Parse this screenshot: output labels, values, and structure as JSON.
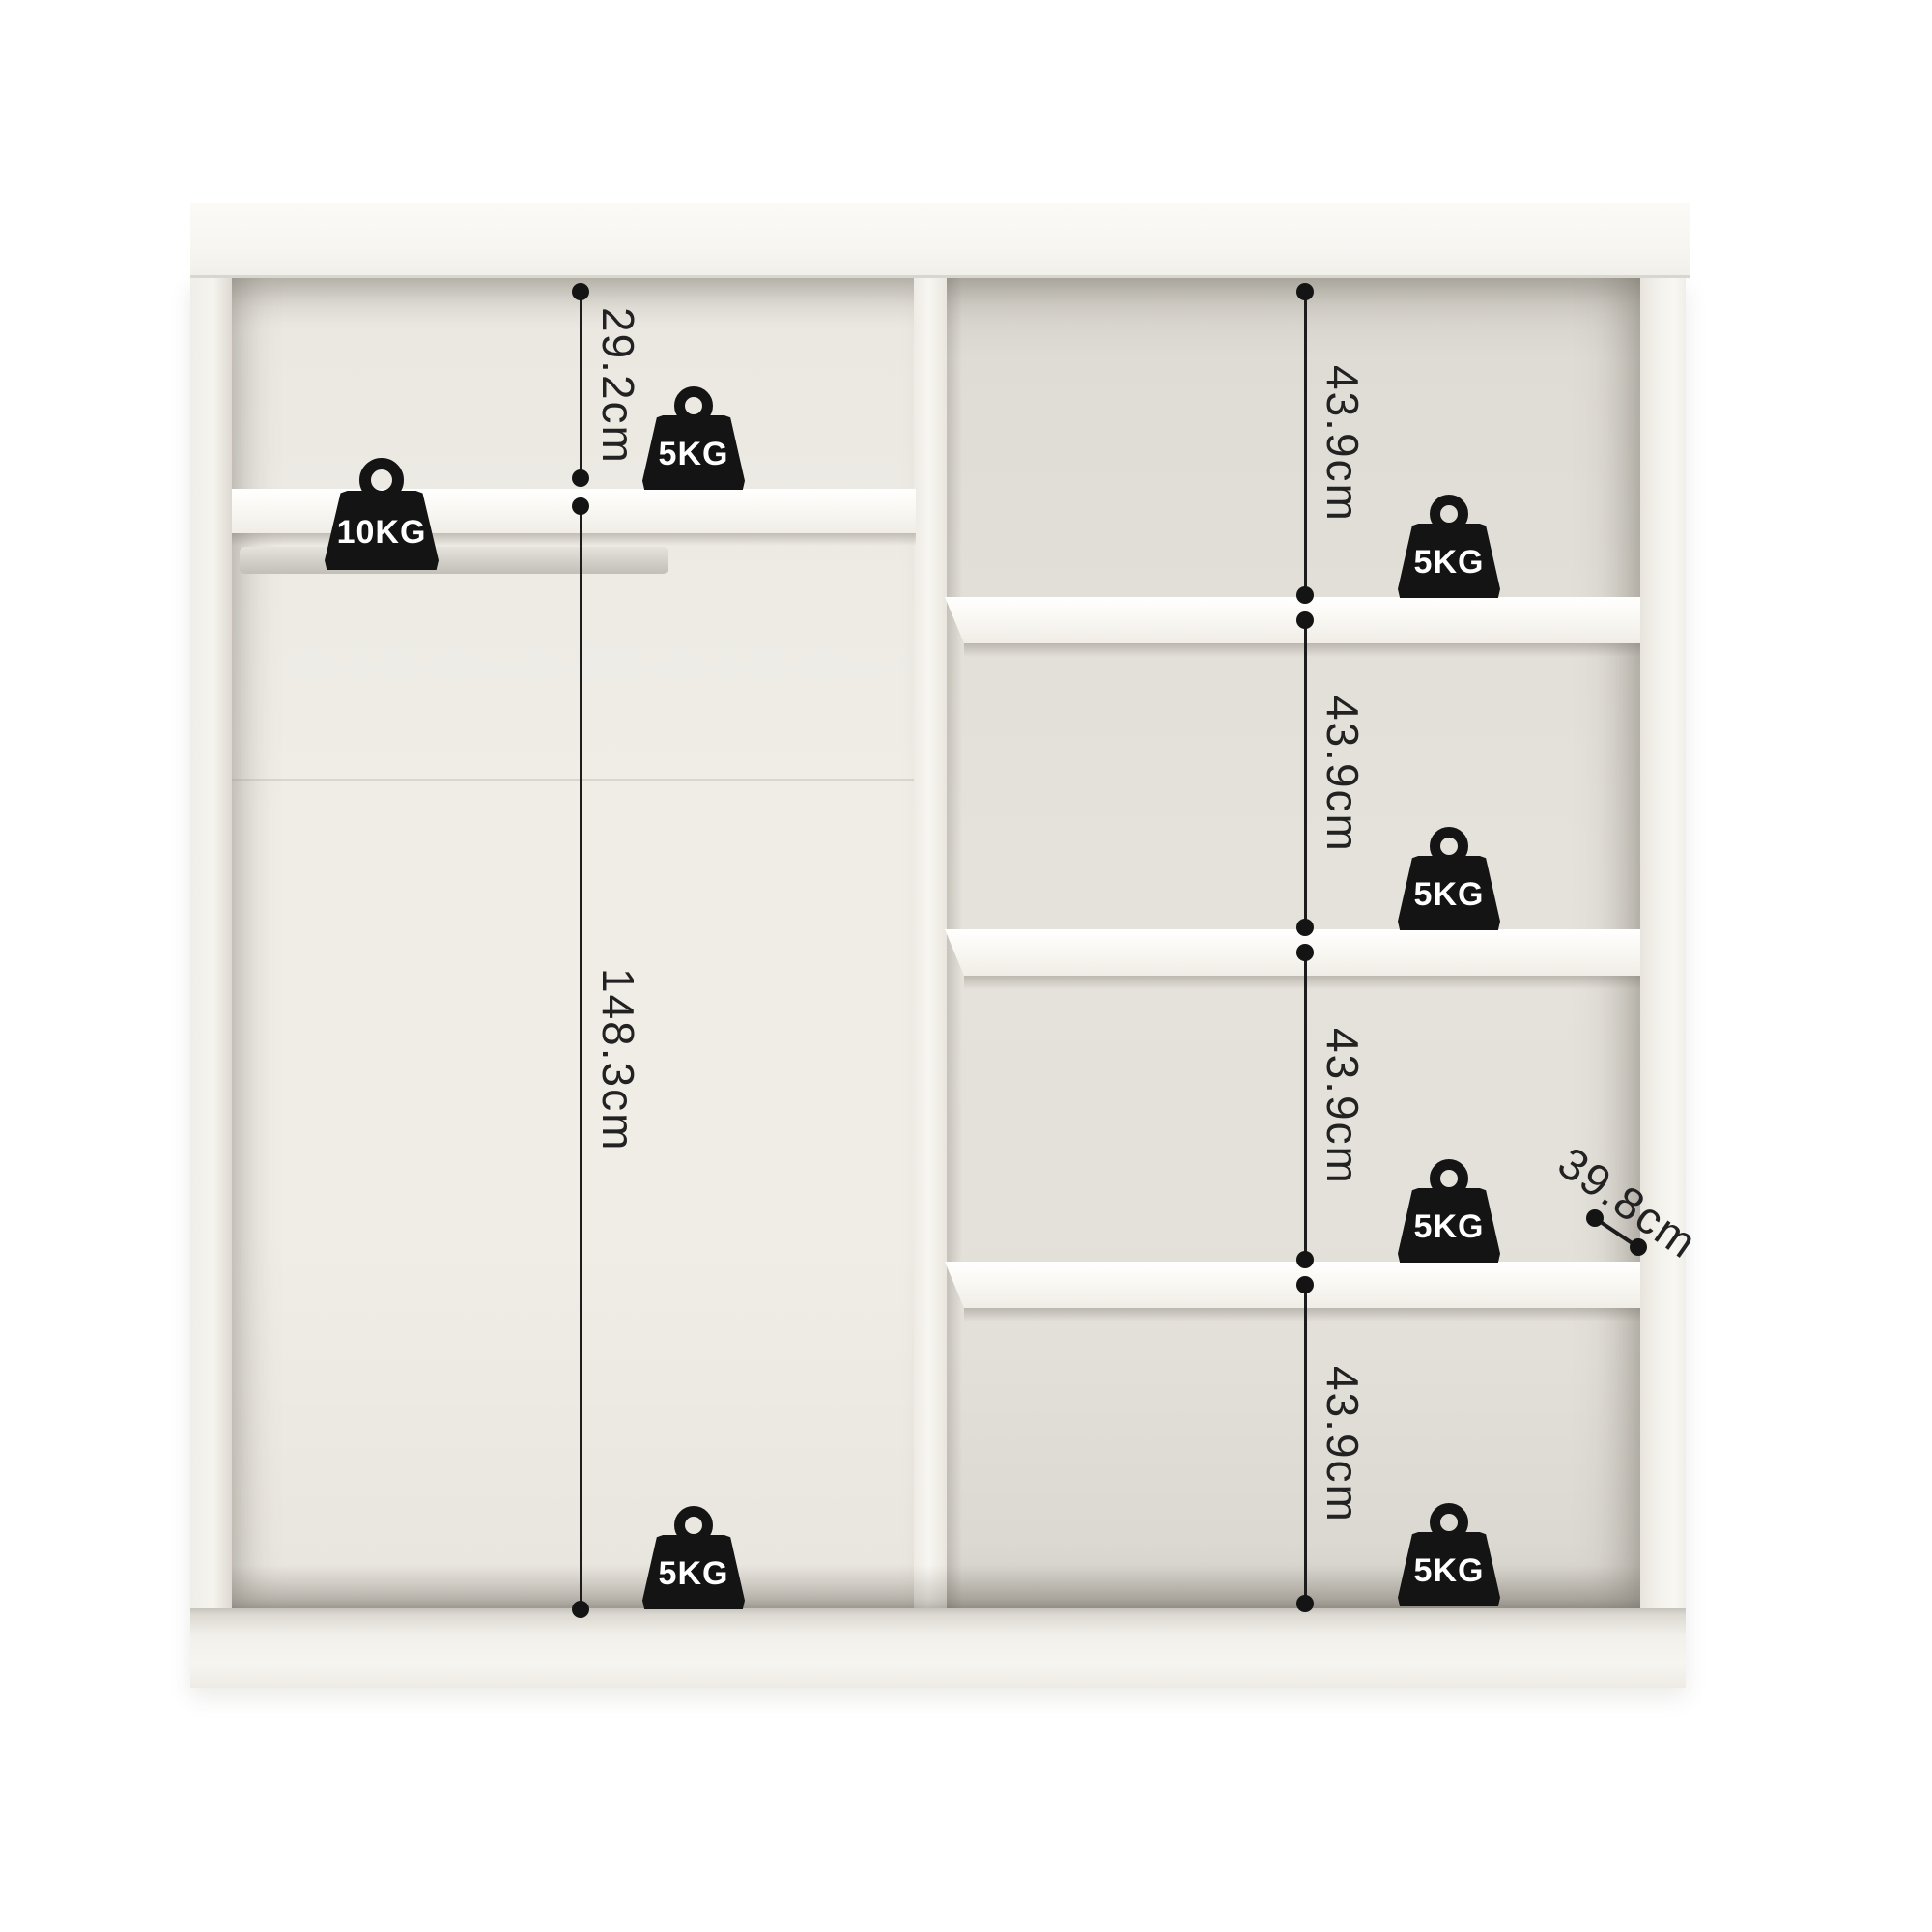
{
  "page": {
    "background": "#ffffff"
  },
  "diagram": {
    "subject": "Wardrobe internal dimensions",
    "measurements": {
      "top_left_height": "29.2cm",
      "left_height": "148.3cm",
      "right_cell_heights": [
        "43.9cm",
        "43.9cm",
        "43.9cm",
        "43.9cm"
      ],
      "shelf_depth": "39.8cm"
    },
    "weights": {
      "hanging_rod": "10KG",
      "left_top_shelf": "5KG",
      "left_bottom": "5KG",
      "right_cells": [
        "5KG",
        "5KG",
        "5KG",
        "5KG"
      ]
    },
    "colors": {
      "dimension_line": "#1c1c1c",
      "weight_icon": "#141414",
      "weight_label": "#ffffff",
      "cabinet_white": "#f6f4ef",
      "interior_left_back": "#efece6",
      "interior_right_back": "#e3e0d9"
    }
  }
}
